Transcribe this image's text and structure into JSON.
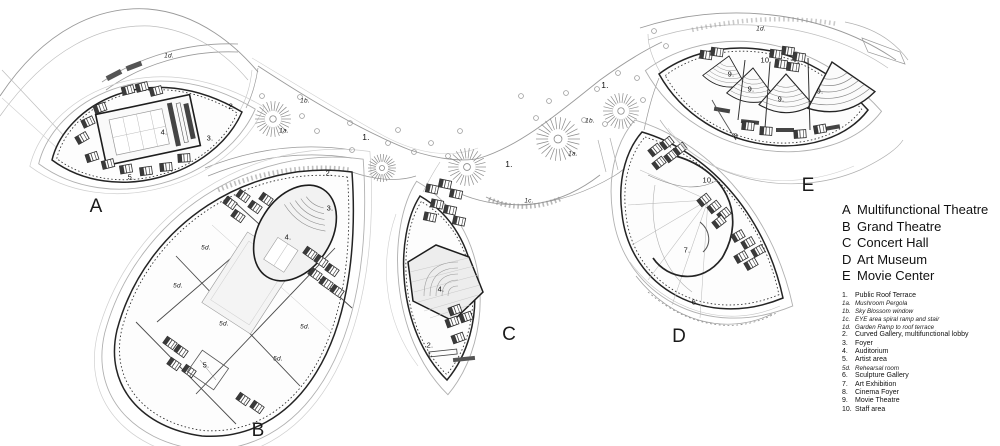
{
  "legend": {
    "buildings": [
      {
        "letter": "A",
        "name": "Multifunctional Theatre"
      },
      {
        "letter": "B",
        "name": "Grand Theatre"
      },
      {
        "letter": "C",
        "name": "Concert Hall"
      },
      {
        "letter": "D",
        "name": "Art Museum"
      },
      {
        "letter": "E",
        "name": "Movie Center"
      }
    ],
    "items": [
      {
        "num": "1.",
        "label": "Public Roof Terrace",
        "italic": false
      },
      {
        "num": "1a.",
        "label": "Mushroom Pergola",
        "italic": true
      },
      {
        "num": "1b.",
        "label": "Sky Blossom window",
        "italic": true
      },
      {
        "num": "1c.",
        "label": "EYE area spiral ramp and stair",
        "italic": true
      },
      {
        "num": "1d.",
        "label": "Garden Ramp to roof terrace",
        "italic": true
      },
      {
        "num": "2.",
        "label": "Curved Gallery, multifunctional lobby",
        "italic": false
      },
      {
        "num": "3.",
        "label": "Foyer",
        "italic": false
      },
      {
        "num": "4.",
        "label": "Auditorium",
        "italic": false
      },
      {
        "num": "5.",
        "label": "Artist area",
        "italic": false
      },
      {
        "num": "5d.",
        "label": "Rehearsal room",
        "italic": true
      },
      {
        "num": "6.",
        "label": "Sculpture Gallery",
        "italic": false
      },
      {
        "num": "7.",
        "label": "Art Exhibition",
        "italic": false
      },
      {
        "num": "8.",
        "label": "Cinema Foyer",
        "italic": false
      },
      {
        "num": "9.",
        "label": "Movie Theatre",
        "italic": false
      },
      {
        "num": "10.",
        "label": "Staff area",
        "italic": false
      }
    ]
  },
  "plan": {
    "building_letters": [
      {
        "text": "A",
        "x": 96,
        "y": 207
      },
      {
        "text": "B",
        "x": 258,
        "y": 431
      },
      {
        "text": "C",
        "x": 509,
        "y": 335
      },
      {
        "text": "D",
        "x": 679,
        "y": 337
      },
      {
        "text": "E",
        "x": 808,
        "y": 186
      }
    ],
    "labels": [
      {
        "text": "1d.",
        "x": 169,
        "y": 56,
        "sub": true
      },
      {
        "text": "2.",
        "x": 232,
        "y": 106
      },
      {
        "text": "3.",
        "x": 210,
        "y": 138
      },
      {
        "text": "4.",
        "x": 164,
        "y": 132
      },
      {
        "text": "5.",
        "x": 131,
        "y": 177
      },
      {
        "text": "1a.",
        "x": 284,
        "y": 131,
        "sub": true
      },
      {
        "text": "1b.",
        "x": 305,
        "y": 101,
        "sub": true
      },
      {
        "text": "1.",
        "x": 366,
        "y": 137,
        "big": true
      },
      {
        "text": "2.",
        "x": 329,
        "y": 173
      },
      {
        "text": "3.",
        "x": 330,
        "y": 208
      },
      {
        "text": "4.",
        "x": 288,
        "y": 237
      },
      {
        "text": "5d.",
        "x": 206,
        "y": 248,
        "sub": true
      },
      {
        "text": "5d.",
        "x": 178,
        "y": 286,
        "sub": true
      },
      {
        "text": "5d.",
        "x": 224,
        "y": 324,
        "sub": true
      },
      {
        "text": "5d.",
        "x": 305,
        "y": 327,
        "sub": true
      },
      {
        "text": "5d.",
        "x": 278,
        "y": 359,
        "sub": true
      },
      {
        "text": "5.",
        "x": 206,
        "y": 365
      },
      {
        "text": "4.",
        "x": 441,
        "y": 289
      },
      {
        "text": "2.",
        "x": 430,
        "y": 345
      },
      {
        "text": "1.",
        "x": 509,
        "y": 164,
        "big": true
      },
      {
        "text": "1c.",
        "x": 529,
        "y": 201,
        "sub": true
      },
      {
        "text": "1a.",
        "x": 573,
        "y": 154,
        "sub": true
      },
      {
        "text": "1b.",
        "x": 590,
        "y": 121,
        "sub": true
      },
      {
        "text": "1.",
        "x": 605,
        "y": 85,
        "big": true
      },
      {
        "text": "1d.",
        "x": 761,
        "y": 29,
        "sub": true
      },
      {
        "text": "10.",
        "x": 766,
        "y": 60
      },
      {
        "text": "9.",
        "x": 731,
        "y": 74
      },
      {
        "text": "9.",
        "x": 751,
        "y": 89
      },
      {
        "text": "9.",
        "x": 781,
        "y": 99
      },
      {
        "text": "9.",
        "x": 820,
        "y": 91
      },
      {
        "text": "8.",
        "x": 737,
        "y": 136
      },
      {
        "text": "10.",
        "x": 708,
        "y": 180
      },
      {
        "text": "7.",
        "x": 687,
        "y": 250
      },
      {
        "text": "6.",
        "x": 695,
        "y": 302
      }
    ],
    "pergolas": [
      {
        "x": 273,
        "y": 119,
        "r": 18
      },
      {
        "x": 382,
        "y": 168,
        "r": 14
      },
      {
        "x": 467,
        "y": 167,
        "r": 19
      },
      {
        "x": 558,
        "y": 139,
        "r": 22
      },
      {
        "x": 621,
        "y": 111,
        "r": 18
      }
    ],
    "blossoms": [
      {
        "x": 262,
        "y": 96
      },
      {
        "x": 300,
        "y": 97
      },
      {
        "x": 302,
        "y": 116
      },
      {
        "x": 317,
        "y": 131
      },
      {
        "x": 350,
        "y": 123
      },
      {
        "x": 352,
        "y": 150
      },
      {
        "x": 388,
        "y": 143
      },
      {
        "x": 398,
        "y": 130
      },
      {
        "x": 414,
        "y": 152
      },
      {
        "x": 431,
        "y": 143
      },
      {
        "x": 448,
        "y": 156
      },
      {
        "x": 460,
        "y": 131
      },
      {
        "x": 521,
        "y": 96
      },
      {
        "x": 536,
        "y": 118
      },
      {
        "x": 549,
        "y": 101
      },
      {
        "x": 566,
        "y": 93
      },
      {
        "x": 584,
        "y": 120
      },
      {
        "x": 597,
        "y": 89
      },
      {
        "x": 605,
        "y": 124
      },
      {
        "x": 618,
        "y": 73
      },
      {
        "x": 637,
        "y": 78
      },
      {
        "x": 643,
        "y": 100
      },
      {
        "x": 654,
        "y": 31
      },
      {
        "x": 666,
        "y": 46
      }
    ]
  },
  "colors": {
    "paper": "#ffffff",
    "line_dark": "#242424",
    "line_mid": "#8a8a8a",
    "line_light": "#bdbdbd",
    "fill_hall": "#ededed"
  }
}
